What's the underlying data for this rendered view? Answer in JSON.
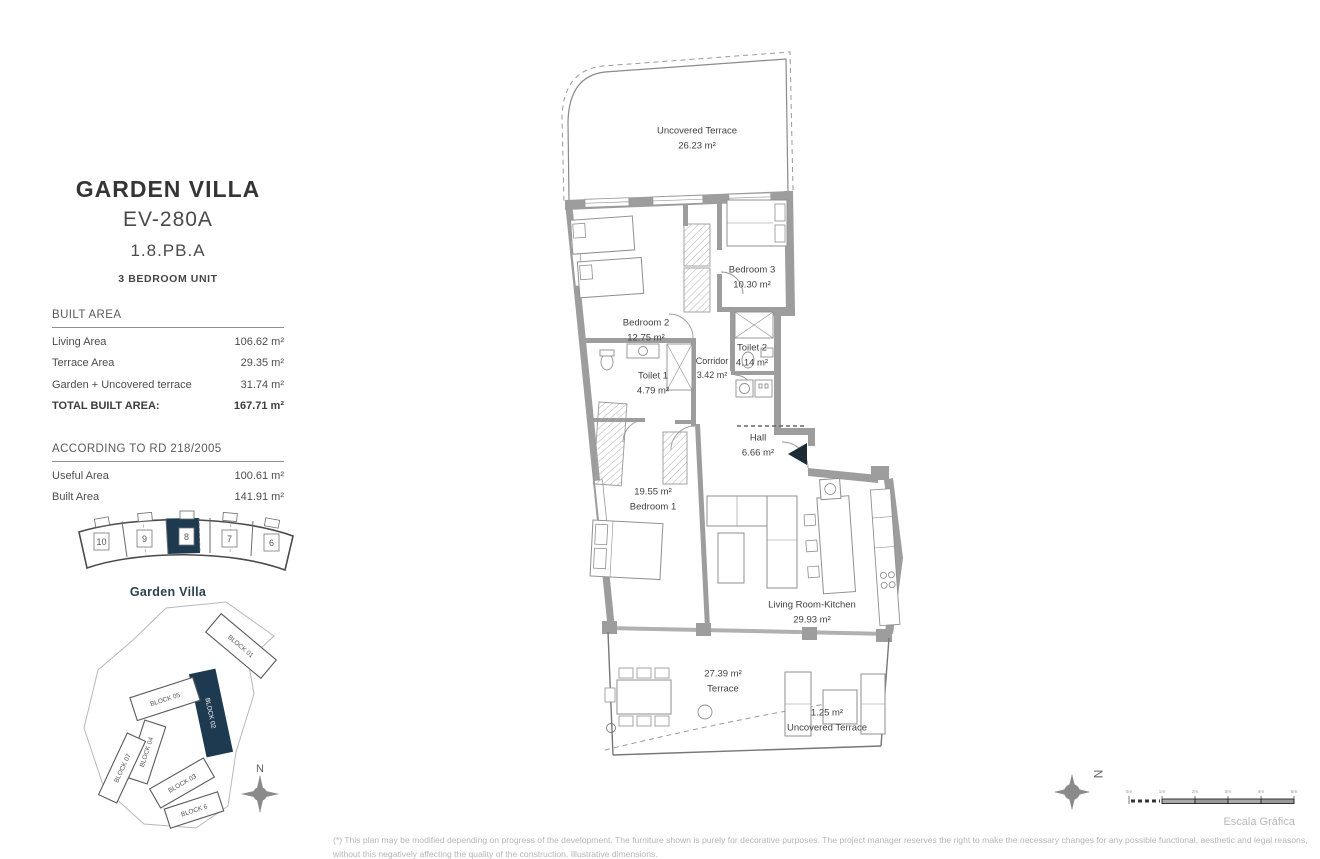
{
  "title_block": {
    "title": "GARDEN VILLA",
    "unit_code": "EV-280A",
    "unit_ref": "1.8.PB.A",
    "unit_type": "3 BEDROOM UNIT"
  },
  "built_area": {
    "header": "BUILT AREA",
    "rows": [
      {
        "label": "Living Area",
        "value": "106.62 m²"
      },
      {
        "label": "Terrace Area",
        "value": "29.35 m²"
      },
      {
        "label": "Garden + Uncovered terrace",
        "value": "31.74 m²"
      }
    ],
    "total_label": "TOTAL BUILT AREA:",
    "total_value": "167.71 m²"
  },
  "rd_area": {
    "header": "ACCORDING TO RD 218/2005",
    "rows": [
      {
        "label": "Useful Area",
        "value": "100.61 m²"
      },
      {
        "label": "Built Area",
        "value": "141.91 m²"
      }
    ]
  },
  "unit_strip": {
    "units": [
      "10",
      "9",
      "8",
      "7",
      "6"
    ],
    "highlighted_unit": "8",
    "caption": "Garden Villa"
  },
  "site_plan": {
    "blocks": [
      "BLOCK 01",
      "BLOCK 02",
      "BLOCK 05",
      "BLOCK 04",
      "BLOCK 07",
      "BLOCK 03",
      "BLOCK 6"
    ],
    "highlighted_block": "BLOCK 02",
    "compass_label": "N"
  },
  "floor_plan": {
    "rooms": [
      {
        "name": "Uncovered Terrace",
        "area": "26.23 m²"
      },
      {
        "name": "Bedroom 2",
        "area": "12.75 m²"
      },
      {
        "name": "Bedroom 3",
        "area": "10.30 m²"
      },
      {
        "name": "Toilet 1",
        "area": "4.79 m²"
      },
      {
        "name": "Corridor",
        "area": "3.42 m²"
      },
      {
        "name": "Toilet 2",
        "area": "4.14 m²"
      },
      {
        "name": "Hall",
        "area": "6.66 m²"
      },
      {
        "name": "Bedroom 1",
        "area": "19.55 m²"
      },
      {
        "name": "Living Room-Kitchen",
        "area": "29.93 m²"
      },
      {
        "name": "Terrace",
        "area": "27.39 m²"
      },
      {
        "name": "Uncovered Terrace",
        "area": "1.25 m²"
      }
    ],
    "compass_label": "N"
  },
  "scale_bar": {
    "ticks": [
      "0m",
      "1m",
      "2m",
      "3m",
      "4m",
      "5m"
    ],
    "caption": "Escala Gráfica"
  },
  "footnote": "(*) This plan may be modified depending on progress of the development. The furniture shown is purely for decorative purposes. The project manager reserves the right to make the necessary changes for any possible functional, aesthetic and legal reasons, without this negatively affecting the quality of the construction. Illustrative dimensions.",
  "colors": {
    "accent_navy": "#1d3a50",
    "wall_gray": "#9d9d9d",
    "muted_gray": "#b5b5b5"
  }
}
